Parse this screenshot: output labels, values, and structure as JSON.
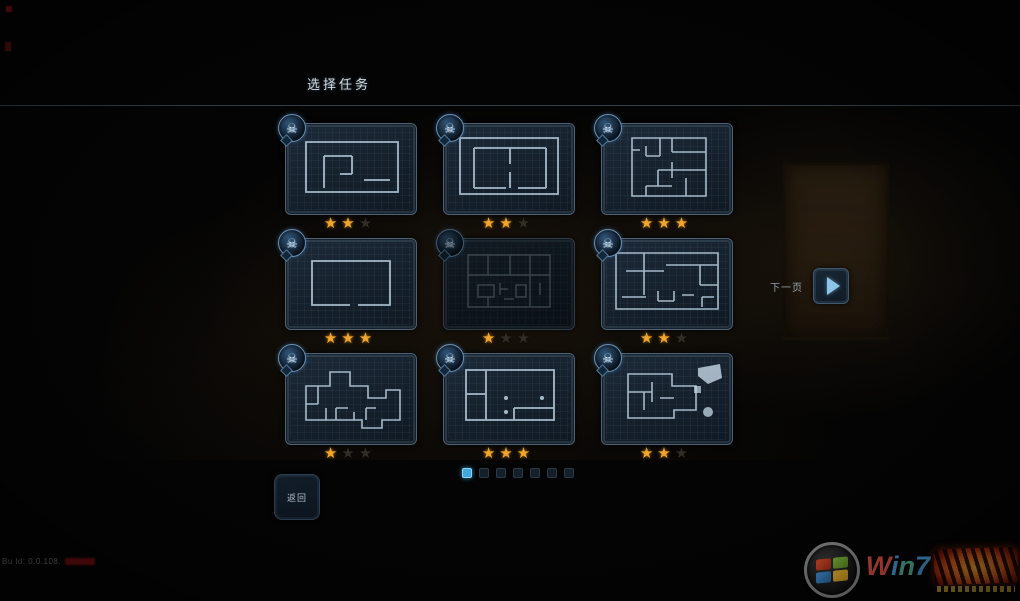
{
  "title": "选择任务",
  "icons": {
    "skull_glyph": "☠",
    "next_button": "play-icon",
    "back_button_icon": "none",
    "star_glyph": "★"
  },
  "missions": [
    {
      "id": 1,
      "stars": 2,
      "max_stars": 3,
      "dimmed": false
    },
    {
      "id": 2,
      "stars": 2,
      "max_stars": 3,
      "dimmed": false
    },
    {
      "id": 3,
      "stars": 3,
      "max_stars": 3,
      "dimmed": false
    },
    {
      "id": 4,
      "stars": 3,
      "max_stars": 3,
      "dimmed": false
    },
    {
      "id": 5,
      "stars": 1,
      "max_stars": 3,
      "dimmed": true
    },
    {
      "id": 6,
      "stars": 2,
      "max_stars": 3,
      "dimmed": false
    },
    {
      "id": 7,
      "stars": 1,
      "max_stars": 3,
      "dimmed": false
    },
    {
      "id": 8,
      "stars": 3,
      "max_stars": 3,
      "dimmed": false
    },
    {
      "id": 9,
      "stars": 2,
      "max_stars": 3,
      "dimmed": false
    }
  ],
  "pager": {
    "next_label": "下一页",
    "dots_total": 7,
    "active_dot_index": 0
  },
  "back_button_label": "返回",
  "build_text": "Bu ld: 0.0.108.",
  "watermark_brand": "Win7",
  "colors": {
    "star_earned": "#f0a52e",
    "star_empty": "#322d25",
    "dot_active": "#3fa9e0",
    "blueprint_line": "#bed0de",
    "accent_blue": "#8ec4e8",
    "card_border": "#4d6276"
  }
}
